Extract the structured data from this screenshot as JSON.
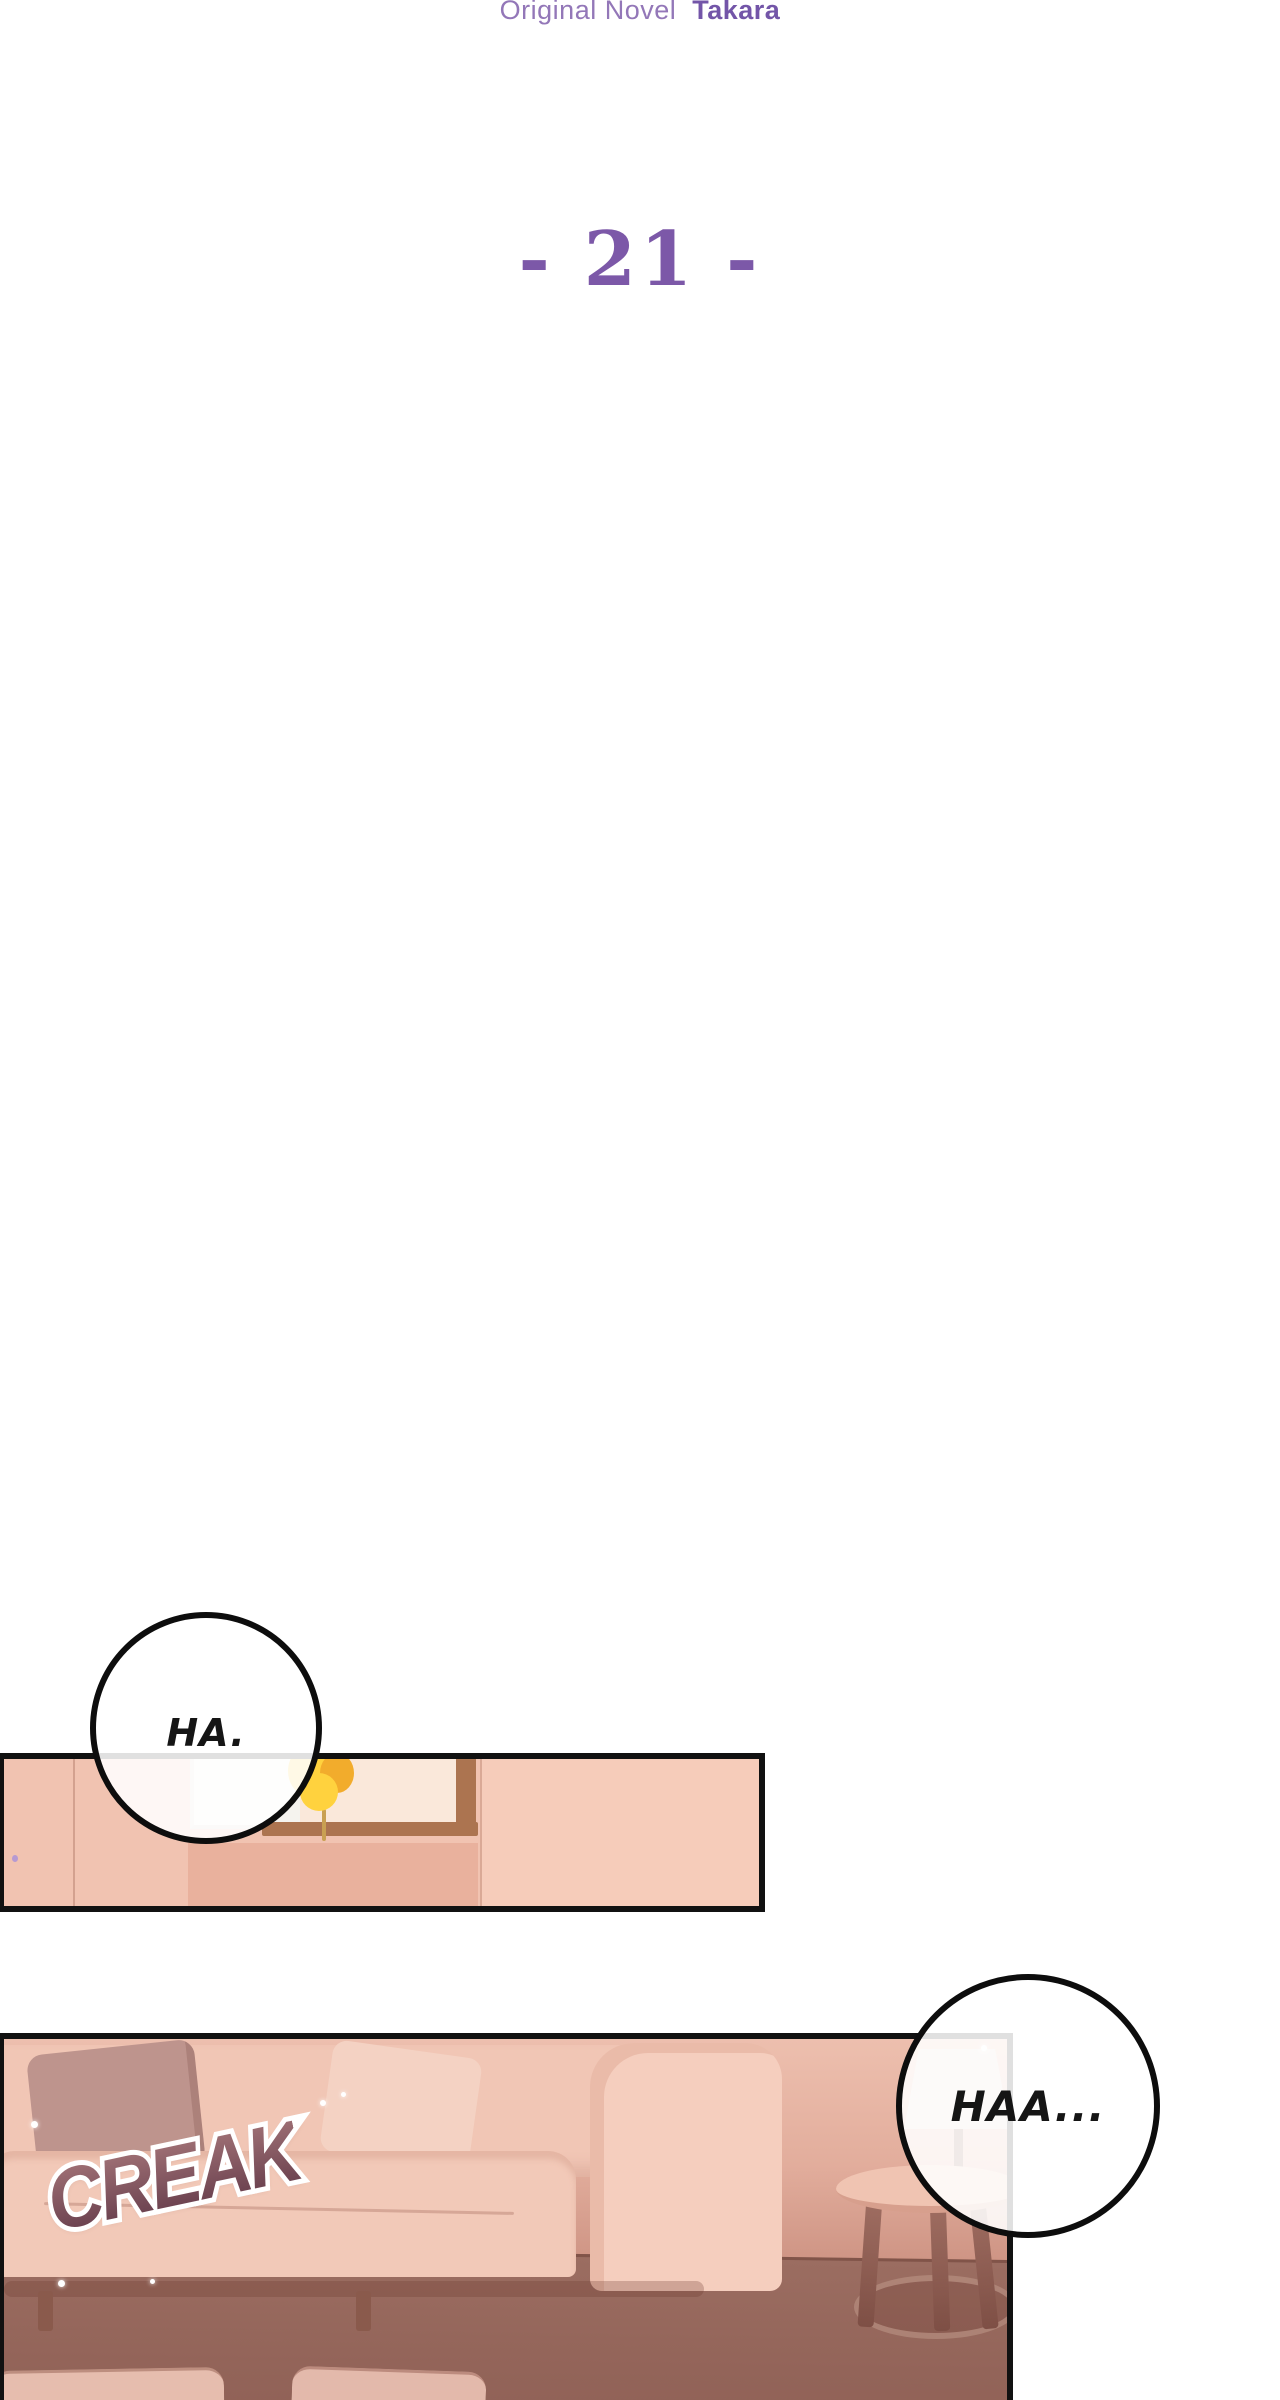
{
  "header": {
    "credit": {
      "prefix": "Original Novel",
      "name": "Takara"
    },
    "chapter": "- 21 -"
  },
  "speech": {
    "bubble1": "HA.",
    "bubble2": "HAA..."
  },
  "sfx": {
    "creak": "CREAK"
  },
  "colors": {
    "page-bg": "#FFFFFF",
    "purple": "#9377B8",
    "purple-bold": "#7355A8",
    "purple-chapter": "#7C58A8",
    "ink": "#111111",
    "wall-pink": "#F1C3B1",
    "wall-pink-light": "#F6CCBA",
    "window-white": "#F5F3EE",
    "frame-brown": "#AC7450",
    "frame-inner": "#FAE8DA",
    "flower": "#FFD23E",
    "flower-deep": "#F2AC2C",
    "stem": "#C9A052",
    "sideboard": "#E9B19D",
    "couch": "#F1C6B5",
    "couch-light": "#F5CEBE",
    "seat": "#F2C9B8",
    "pillow": "#BE948D",
    "table-top": "#F0C4B2",
    "table-rim": "#D79F8D",
    "cushion": "#E6BDAE",
    "lamp": "#E9DAD2",
    "lamp-stem": "#8A5B50",
    "sfx-top": "#9E6F74",
    "sfx-bottom": "#69404E"
  }
}
